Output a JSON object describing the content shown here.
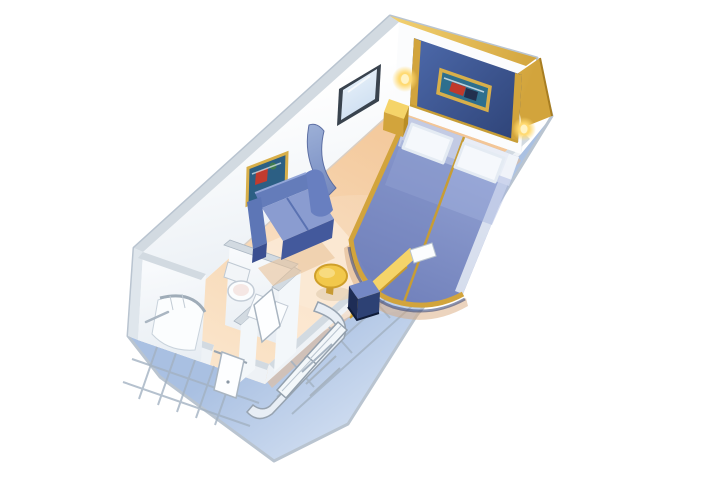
{
  "scene": {
    "description": "Isometric cutaway rendering of a cruise ship interior stateroom floor plan",
    "room_type": "interior-stateroom",
    "view": "isometric-cutaway-3d",
    "background_color": "#ffffff"
  },
  "palette": {
    "floor_top": "#f3c697",
    "floor_front": "#fbe8d0",
    "floor_shadow": "#ecba8c",
    "floor_light": "#fcead6",
    "band_inner": "#a9c0e2",
    "band_outer": "#eaf1fa",
    "silhouette_rim": "#b9c4d0",
    "wall_white": "#ffffff",
    "wall_shade": "#e7edf3",
    "wall_cap": "#d2dae1",
    "accent_blue": "#4a66a6",
    "accent_blue_dark": "#2e4377",
    "gold": "#d2a43c",
    "gold_bright": "#f1cf6f",
    "gold_deep": "#b98d25",
    "bed_light": "#97a6d6",
    "bed_dark": "#7282bc",
    "pillow": "#f5f8fc",
    "sofa_back": "#647cba",
    "sofa_seat": "#8a9cd0",
    "sofa_front": "#43599c",
    "partition_light": "#9aaed6",
    "partition_dark": "#6b82bd",
    "table_yellow": "#f2c84b",
    "stool_top": "#7488c5",
    "stool_front": "#2d4174",
    "desk_gold": "#e9bc43",
    "desk_top": "#f5d469",
    "bath_white": "#fbfdfe",
    "fixture_line": "#c3ccd6",
    "mirror_frame": "#39434e",
    "art_teal": "#2e6f8e",
    "art_red": "#c0392b",
    "sconce_glow": "#ffd96e"
  },
  "elements": {
    "bedroom": {
      "accent_wall": "headboard accent wall with gold trim",
      "artwork_over_bed": "framed seascape artwork",
      "sconce_count": 2,
      "beds": "two twin beds pushed together with blue bedspreads",
      "pillow_count": 2,
      "nightstand": "gold bedside table",
      "bed_base": "curved gold bed base rim"
    },
    "sitting_area": {
      "sofa": "blue loveseat sofa",
      "coffee_table": "round yellow table",
      "artwork": "framed artwork above sofa",
      "mirror": "wall mirror",
      "partition": "curved blue room divider"
    },
    "vanity_area": {
      "desk": "gold vanity desk",
      "stool": "blue desk stool",
      "tv_panel": "white tv panel above desk"
    },
    "bathroom": {
      "shower": "curved corner shower stall",
      "toilet": "toilet",
      "sink": "sink vanity",
      "door": "bathroom door",
      "towel_bar": "towel bar"
    },
    "entry": {
      "entrance_door": "entrance door",
      "closet": "sliding-door closet with shelves",
      "hallway": "entry corridor"
    },
    "structure": {
      "exterior_wall": "splayed cutaway exterior wall band",
      "studs": "wall framing studs",
      "crown": "gold crown trim along accent wall top"
    }
  }
}
